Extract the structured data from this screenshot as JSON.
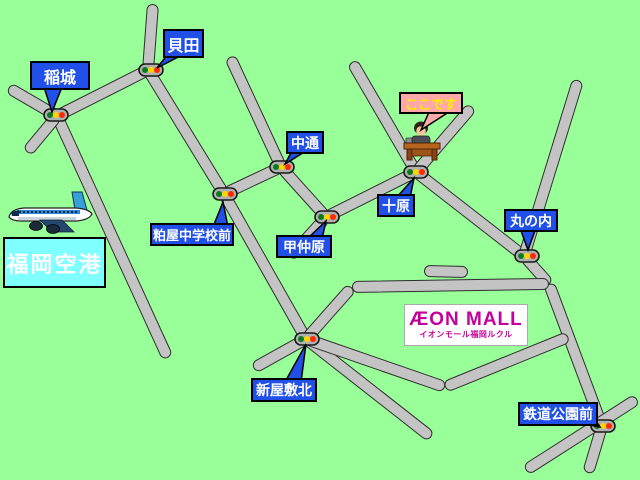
{
  "map": {
    "background_color": "#99ff99",
    "road_fill": "#c4c4c4",
    "road_border": "#2e2e2e",
    "junction_label_color": "#2050e8",
    "junction_label_text_color": "#ffffff",
    "here_box_color": "#ffa8a8",
    "here_text_color": "#ffee00",
    "airport_box_color": "#80ffff",
    "airport_text_color": "#ffffff",
    "mall_text_color": "#c4009a",
    "traffic_light_colors": [
      "#0a7a1e",
      "#ffd400",
      "#ff2a00"
    ],
    "junction_labels": [
      {
        "id": "inagi",
        "label": "稲城"
      },
      {
        "id": "kaida",
        "label": "貝田"
      },
      {
        "id": "nakadori",
        "label": "中通"
      },
      {
        "id": "kasuya-chugakko-mae",
        "label": "粕屋中学校前"
      },
      {
        "id": "konakabaru",
        "label": "甲仲原"
      },
      {
        "id": "tobaru",
        "label": "十原"
      },
      {
        "id": "marunouchi",
        "label": "丸の内"
      },
      {
        "id": "shinyashiki-kita",
        "label": "新屋敷北"
      },
      {
        "id": "tetsudo-koen-mae",
        "label": "鉄道公園前"
      }
    ],
    "here_callout": {
      "label": "ここです"
    },
    "airport": {
      "label": "福岡空港"
    },
    "mall": {
      "name": "ÆON MALL",
      "subtitle": "イオンモール福岡ルクル"
    }
  }
}
